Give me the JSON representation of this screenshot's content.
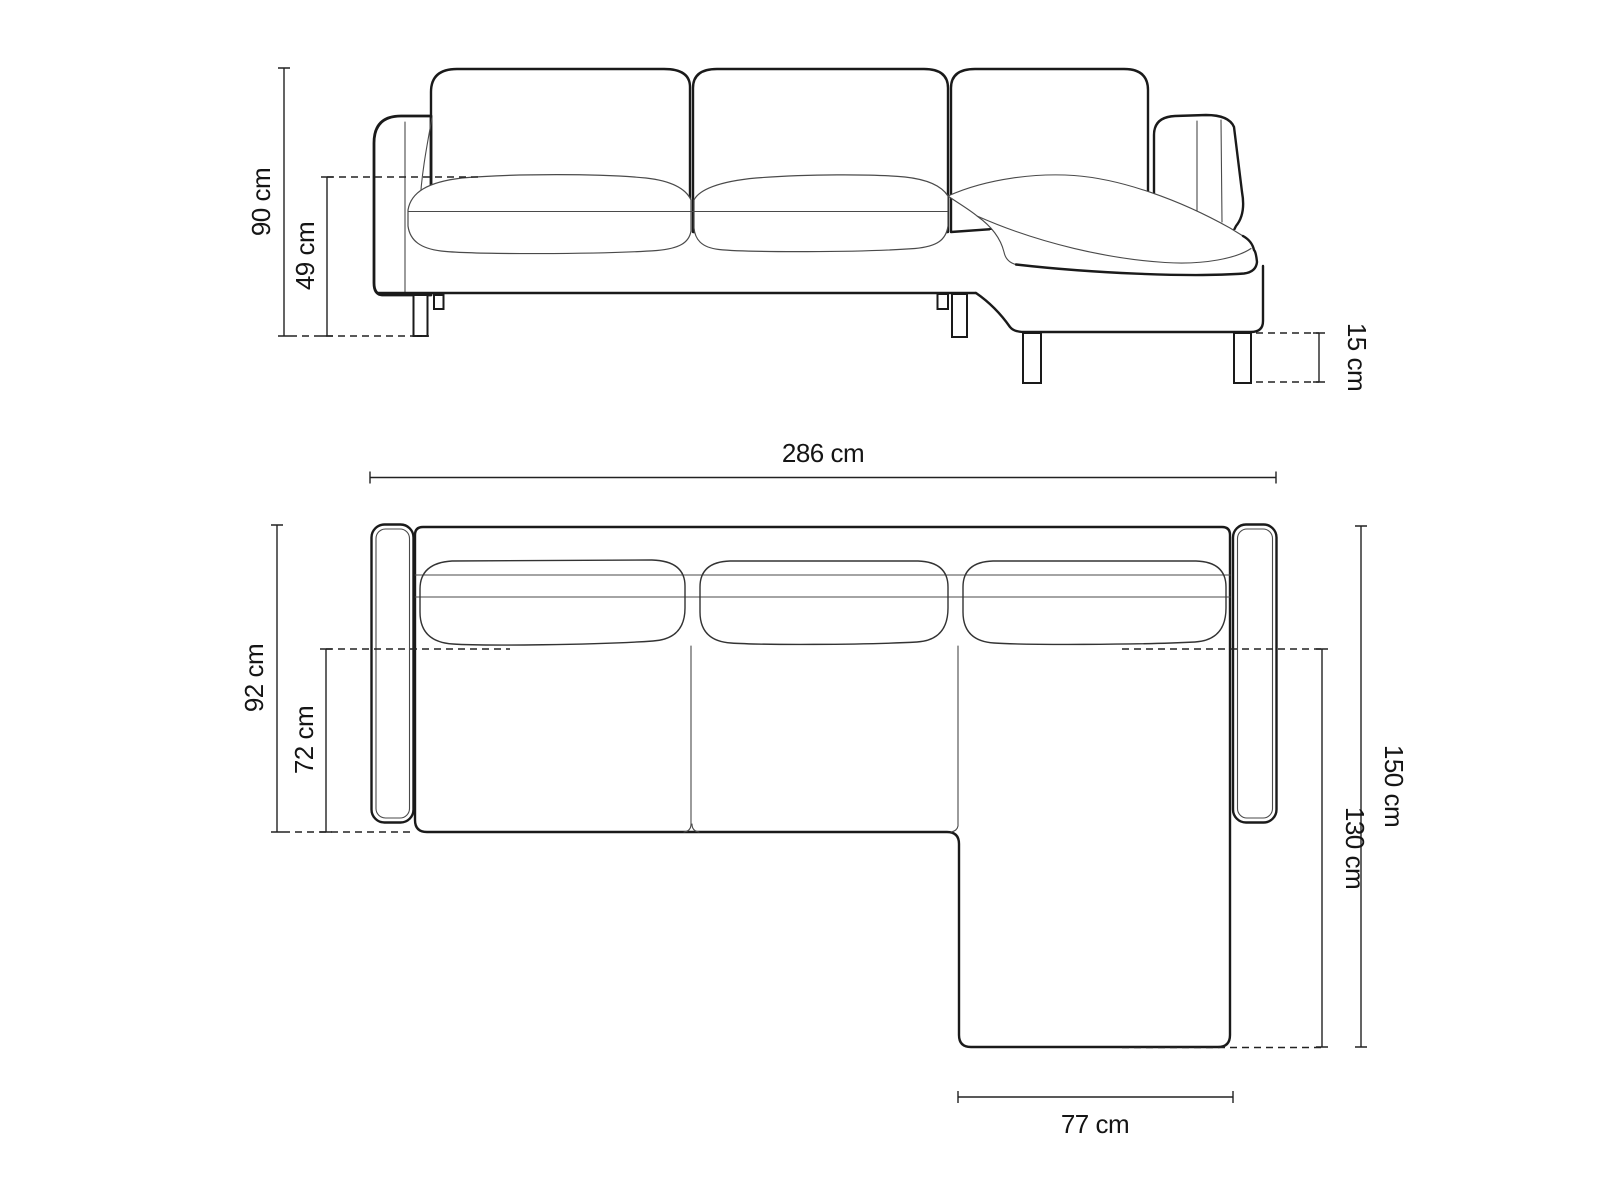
{
  "diagram": {
    "background": "#ffffff",
    "outline_color": "#1a1a1a",
    "seam_color": "#4a4a4a",
    "dimension_color": "#222222",
    "front_view": {
      "dimensions": [
        {
          "id": "overall-height",
          "label": "90 cm",
          "value": 90,
          "unit": "cm"
        },
        {
          "id": "seat-height",
          "label": "49 cm",
          "value": 49,
          "unit": "cm"
        },
        {
          "id": "leg-height",
          "label": "15 cm",
          "value": 15,
          "unit": "cm"
        }
      ]
    },
    "top_view": {
      "dimensions": [
        {
          "id": "overall-width",
          "label": "286 cm",
          "value": 286,
          "unit": "cm"
        },
        {
          "id": "overall-depth",
          "label": "92 cm",
          "value": 92,
          "unit": "cm"
        },
        {
          "id": "seat-depth",
          "label": "72 cm",
          "value": 72,
          "unit": "cm"
        },
        {
          "id": "chaise-total-depth",
          "label": "150 cm",
          "value": 150,
          "unit": "cm"
        },
        {
          "id": "chaise-section-depth",
          "label": "130 cm",
          "value": 130,
          "unit": "cm"
        },
        {
          "id": "chaise-width",
          "label": "77 cm",
          "value": 77,
          "unit": "cm"
        }
      ]
    }
  }
}
